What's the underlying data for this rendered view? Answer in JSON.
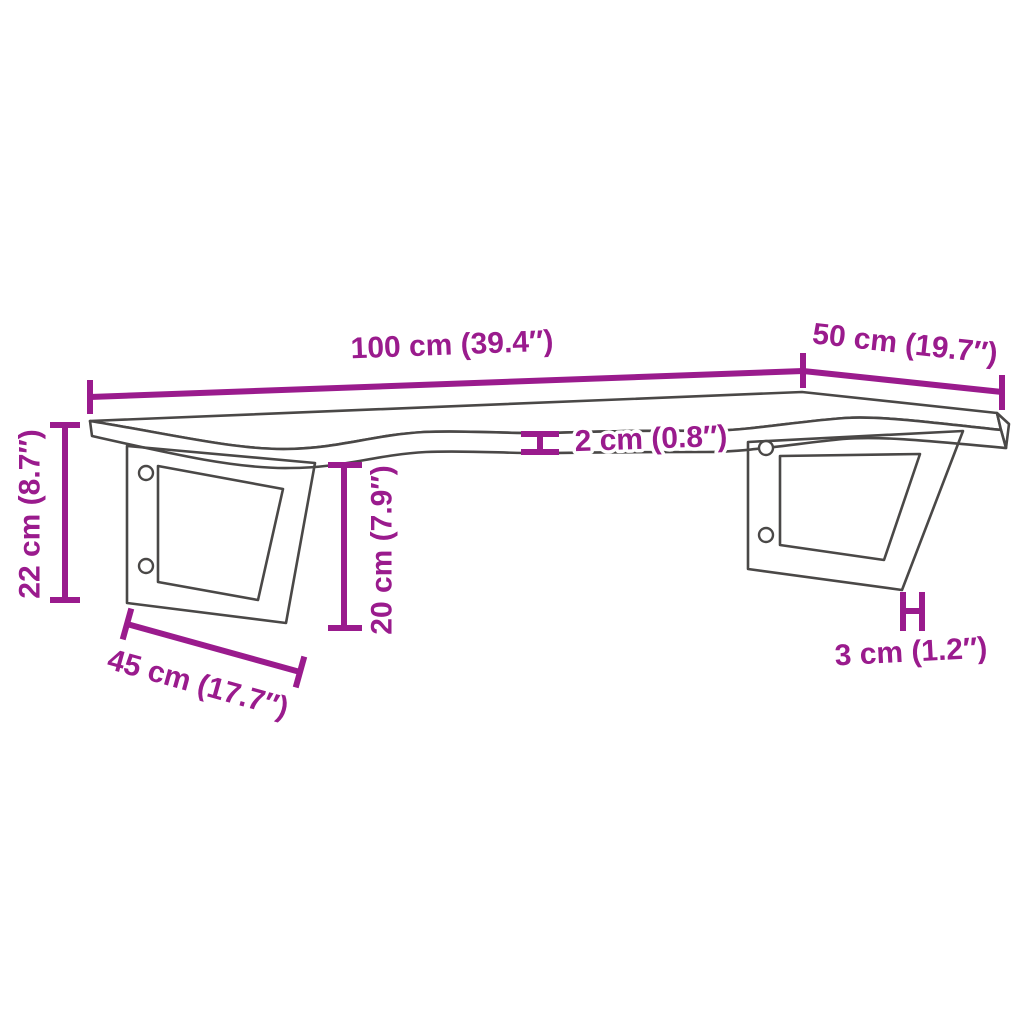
{
  "diagram": {
    "kind": "wall-shelf-dimension-diagram",
    "colors": {
      "dimension_color": "#9a1b8d",
      "outline_color": "#4a4847",
      "background": "#ffffff"
    },
    "dimensions": {
      "length": {
        "label": "100 cm (39.4″)"
      },
      "depth": {
        "label": "50 cm (19.7″)"
      },
      "height": {
        "label": "22 cm (8.7″)"
      },
      "thickness": {
        "label": "2 cm (0.8″)"
      },
      "bracket_height": {
        "label": "20 cm (7.9″)"
      },
      "bracket_depth": {
        "label": "45 cm (17.7″)"
      },
      "bracket_width": {
        "label": "3 cm (1.2″)"
      }
    }
  }
}
